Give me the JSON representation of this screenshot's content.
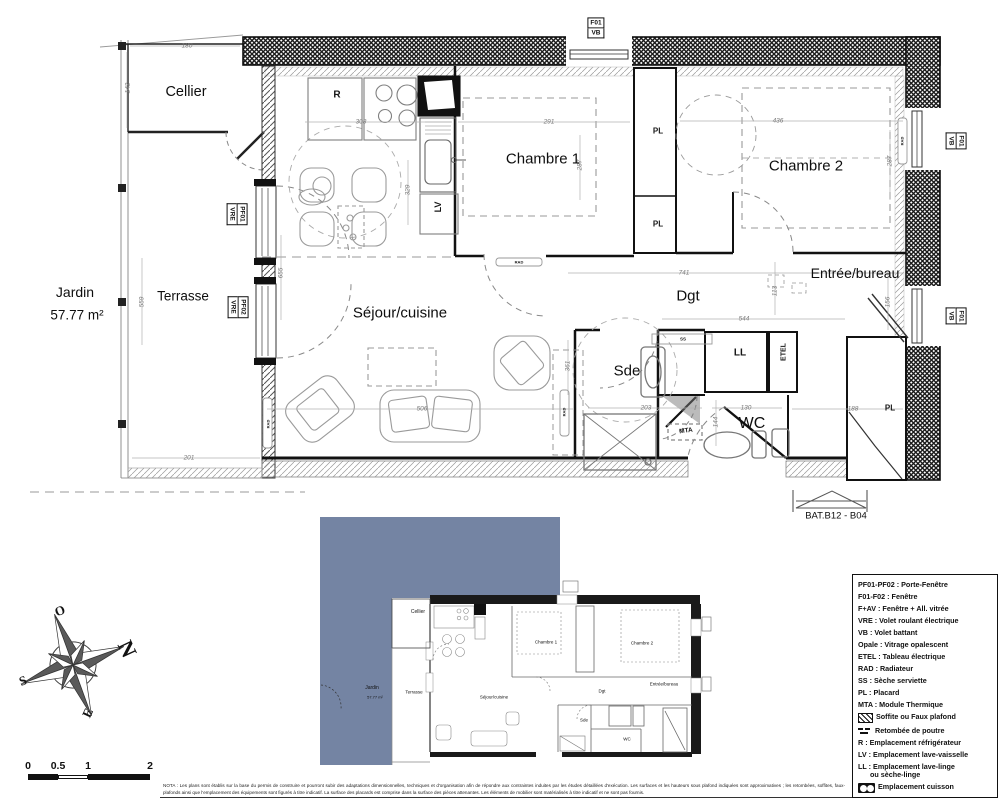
{
  "rooms": {
    "cellier": "Cellier",
    "jardin": "Jardin",
    "jardin_area": "57.77 m²",
    "terrasse": "Terrasse",
    "sejour": "Séjour/cuisine",
    "chambre1": "Chambre 1",
    "chambre2": "Chambre 2",
    "dgt": "Dgt",
    "entree": "Entrée/bureau",
    "sde": "Sde",
    "wc": "WC",
    "bat": "BAT.B12 - B04"
  },
  "dimensions": {
    "cellier_w": "180",
    "cellier_h": "142",
    "kitchen_w": "308",
    "ch1_w": "291",
    "ch2_w": "436",
    "ch1_h": "287",
    "ch2_h": "287",
    "kitchen_h": "329",
    "sejour_h": "655",
    "terrasse_h": "559",
    "dgt_w": "741",
    "dgt_h": "113",
    "entree_h": "156",
    "hall_w": "544",
    "sejour_w": "506",
    "sde_w": "203",
    "wc_w": "130",
    "pl_w": "188",
    "wc_h": "144",
    "terrasse_w": "201",
    "rad_zone_h": "361"
  },
  "fixtures": {
    "fridge": "R",
    "dishwasher": "LV",
    "washer": "LL",
    "elec_panel": "ETEL",
    "thermal_module": "MTA",
    "closet_1": "PL",
    "closet_2": "PL",
    "closet_3": "PL",
    "towel_dryer": "SS",
    "radiator_1": "RAD",
    "radiator_2": "RAD",
    "radiator_3": "RAD",
    "radiator_4": "RAD"
  },
  "window_labels": {
    "f01_top": [
      "F01",
      "VB"
    ],
    "f01_right1": [
      "F01",
      "VB"
    ],
    "f01_right2": [
      "F01",
      "VB"
    ],
    "pf01_left": [
      "PF01",
      "VRE"
    ],
    "pf02_left": [
      "PF02",
      "VRE"
    ]
  },
  "compass": {
    "n": "N",
    "s": "S",
    "e": "E",
    "o": "O"
  },
  "scale_bar": {
    "labels": [
      "0",
      "0.5",
      "1",
      "2"
    ]
  },
  "legend": {
    "items": [
      {
        "icon": "",
        "text": "PF01-PF02 : Porte-Fenêtre"
      },
      {
        "icon": "",
        "text": "F01-F02 : Fenêtre"
      },
      {
        "icon": "",
        "text": "F+AV : Fenêtre + All. vitrée"
      },
      {
        "icon": "",
        "text": "VRE : Volet roulant électrique"
      },
      {
        "icon": "",
        "text": "VB : Volet battant"
      },
      {
        "icon": "",
        "text": "Opale : Vitrage opalescent"
      },
      {
        "icon": "",
        "text": "ETEL : Tableau électrique"
      },
      {
        "icon": "",
        "text": "RAD : Radiateur"
      },
      {
        "icon": "",
        "text": "SS : Sèche serviette"
      },
      {
        "icon": "",
        "text": "PL : Placard"
      },
      {
        "icon": "",
        "text": "MTA : Module Thermique"
      },
      {
        "icon": "soffite",
        "text": "Soffite ou Faux plafond"
      },
      {
        "icon": "beam",
        "text": "Retombée de poutre"
      },
      {
        "icon": "",
        "text": "R : Emplacement réfrigérateur"
      },
      {
        "icon": "",
        "text": "LV : Emplacement lave-vaisselle"
      },
      {
        "icon": "",
        "text": "LL : Emplacement lave-linge\n      ou sèche-linge"
      },
      {
        "icon": "cuisson",
        "text": "Emplacement cuisson"
      }
    ]
  },
  "nota": "NOTA : Les plans sont établis sur la base du permis de construire et pourront subir des adaptations dimensionnelles, techniques et d'organisation afin de répondre aux contraintes induites par les études détaillées d'exécution. Les surfaces et les hauteurs sous plafond indiquées sont approximatives ; les retombées, soffites, faux-plafonds ainsi que l'emplacement des équipements sont figurés à titre indicatif. La surface des placards est comprise dans la surface des pièces attenantes. Les éléments de mobilier sont matérialisés à titre indicatif et ne sont pas fournis.",
  "colors": {
    "jardin_fill": "#7484A3",
    "wall": "#1a1a1a"
  }
}
